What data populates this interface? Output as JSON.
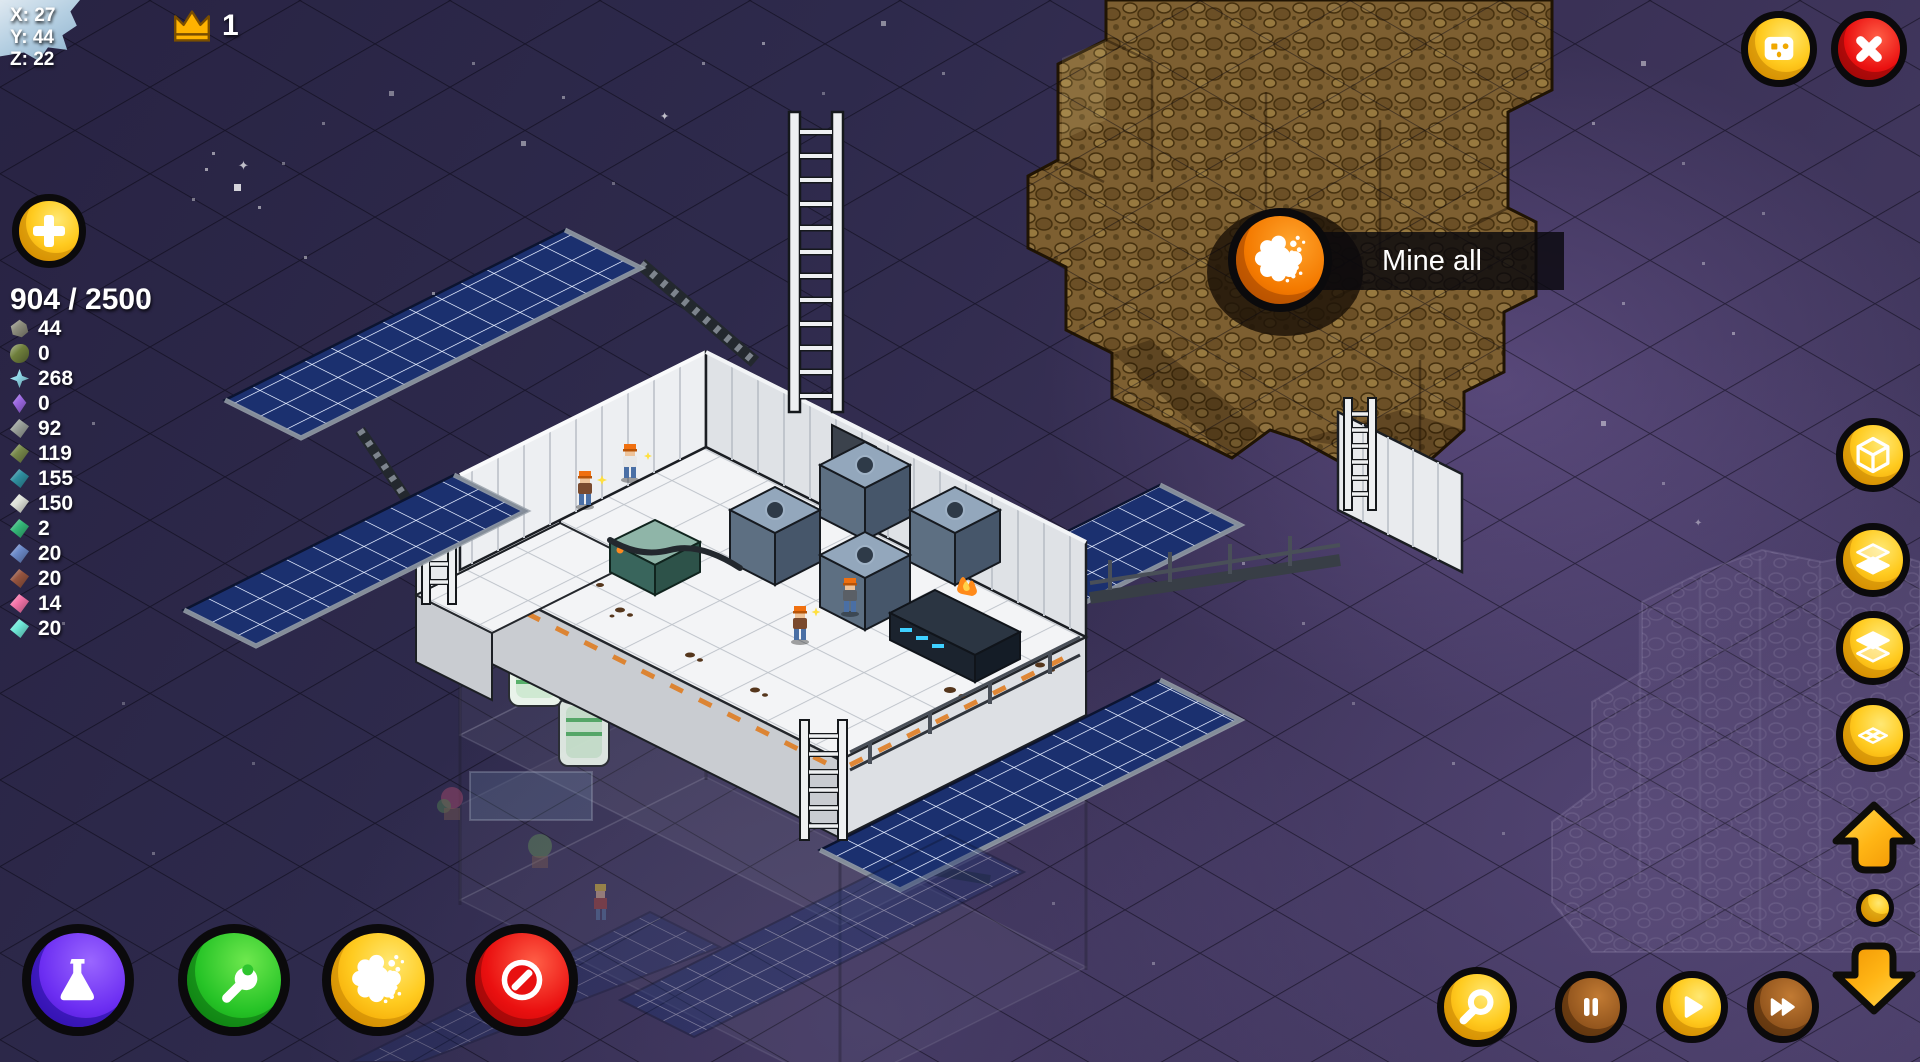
{
  "hud": {
    "coordinates": {
      "x": "X: 27",
      "y": "Y: 44",
      "z": "Z: 22"
    },
    "crown": {
      "count": "1"
    },
    "storage": {
      "label": "904 / 2500"
    },
    "resources": [
      {
        "icon": "rock",
        "color": "#8d8d7d",
        "count": "44"
      },
      {
        "icon": "blob",
        "color": "#6f7f3c",
        "count": "0"
      },
      {
        "icon": "star",
        "color": "#8fd8e8",
        "count": "268"
      },
      {
        "icon": "crystal",
        "color": "#9a66e0",
        "count": "0"
      },
      {
        "icon": "plate",
        "color": "#9aa09a",
        "count": "92"
      },
      {
        "icon": "plate",
        "color": "#77884a",
        "count": "119"
      },
      {
        "icon": "plate",
        "color": "#2f8fa0",
        "count": "155"
      },
      {
        "icon": "plate",
        "color": "#dfe2da",
        "count": "150"
      },
      {
        "icon": "plate",
        "color": "#34b878",
        "count": "2"
      },
      {
        "icon": "plate",
        "color": "#6b89c8",
        "count": "20"
      },
      {
        "icon": "plate",
        "color": "#96543f",
        "count": "20"
      },
      {
        "icon": "plate",
        "color": "#f473a8",
        "count": "14"
      },
      {
        "icon": "plate",
        "color": "#6fe8d8",
        "count": "20"
      }
    ],
    "tooltip": {
      "label": "Mine all"
    }
  },
  "colors": {
    "button_gold": "#ffcb20",
    "button_brown": "#96581f",
    "button_red": "#ea1010",
    "button_purple": "#6c2ef2",
    "button_green": "#27c427",
    "mine_orange": "#f47a00",
    "solar_panel_blue": "#1b306f",
    "asteroid_brown": "#7d5f31",
    "background_purple": "#3a3156",
    "grid_line": "#0a0814",
    "hud_text": "#ffffff",
    "crown_gold": "#ffb300"
  },
  "controls": {
    "top_right": [
      {
        "icon": "robot-face-icon"
      },
      {
        "icon": "close-x-icon"
      }
    ],
    "view_stack": [
      {
        "icon": "cube-wireframe-icon"
      },
      {
        "icon": "layer-above-icon"
      },
      {
        "icon": "layer-below-icon"
      },
      {
        "icon": "grid-flat-icon"
      }
    ],
    "level_nav": [
      {
        "icon": "arrow-up-icon"
      },
      {
        "icon": "dot-icon"
      },
      {
        "icon": "arrow-down-icon"
      }
    ],
    "bottom_left": [
      {
        "icon": "flask-icon"
      },
      {
        "icon": "wrench-icon"
      },
      {
        "icon": "mine-splat-icon"
      },
      {
        "icon": "forbid-icon"
      }
    ],
    "playback": [
      {
        "icon": "magnifier-icon"
      },
      {
        "icon": "pause-icon"
      },
      {
        "icon": "play-icon"
      },
      {
        "icon": "fast-forward-icon"
      }
    ]
  }
}
